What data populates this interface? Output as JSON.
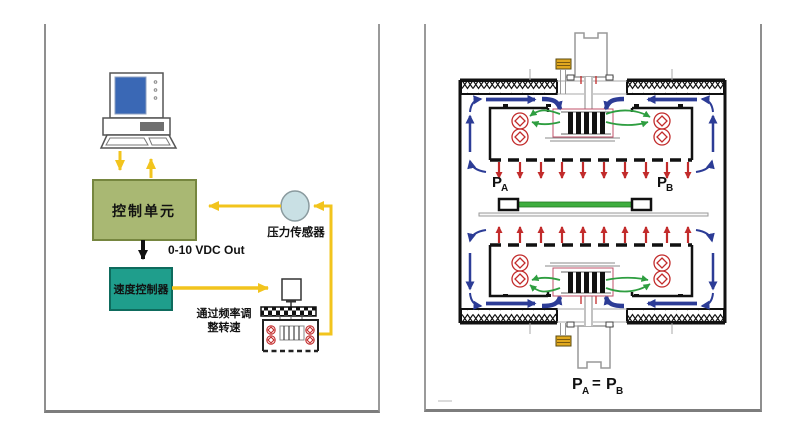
{
  "left_panel": {
    "control_unit": "控制单元",
    "pressure_sensor": "压力传感器",
    "vdc_out": "0-10 VDC Out",
    "speed_controller": "速度控制器",
    "freq_line1": "通过频率调",
    "freq_line2": "整转速"
  },
  "right_panel": {
    "pa": {
      "main": "P",
      "sub": "A"
    },
    "pb": {
      "main": "P",
      "sub": "B"
    },
    "equation": {
      "p1": "P",
      "s1": "A",
      "sign": "=",
      "p2": "P",
      "s2": "B"
    }
  },
  "colors": {
    "signal_yellow": "#f2c41d",
    "control_unit_fill": "#a9b873",
    "control_unit_border": "#76863f",
    "speed_controller_fill": "#1f9e8c",
    "speed_controller_border": "#0e6b5d",
    "sensor_fill": "#c9e0e4",
    "screen_blue": "#3a68b5",
    "flow_red": "#c22b2b",
    "flow_green": "#2e9e40",
    "flow_blue": "#2c3c96",
    "substrate_green": "#3fae3f",
    "component_gold": "#e0a81f",
    "panel_border_gray": "#8f8f8f"
  }
}
